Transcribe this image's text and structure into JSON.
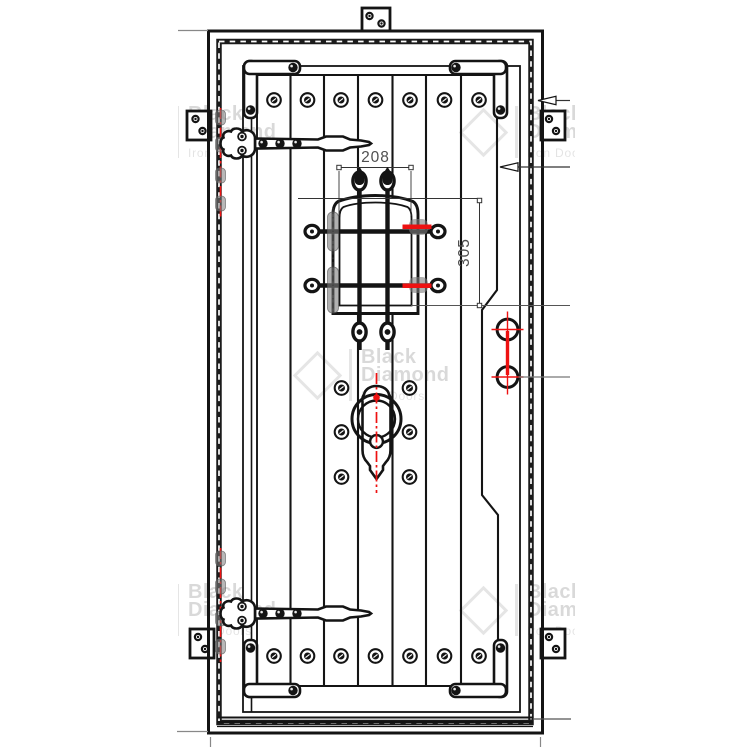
{
  "drawing": {
    "title": "iron entry door shop drawing",
    "dimensions": {
      "speakeasy_opening_width": "208",
      "speakeasy_opening_height": "305"
    },
    "watermark": {
      "brand_line1": "Black",
      "brand_line2": "Diamond",
      "tagline": "Iron Doors"
    },
    "colors": {
      "ink": "#141414",
      "annotation_red": "#ee1111",
      "hardware_gray": "#8a8a8a",
      "leader_gray": "#808080",
      "dimension_text": "#4f4f4f",
      "watermark_gray": "rgba(0,0,0,0.13)",
      "paper": "#ffffff"
    },
    "counts": {
      "plank_screws_top_row": 7,
      "plank_screws_bottom_row": 7,
      "handle_screws": 6,
      "lock_prep_holes": 2,
      "strap_hinges": 2,
      "mounting_tabs": 5,
      "leader_arrows": 2
    }
  }
}
